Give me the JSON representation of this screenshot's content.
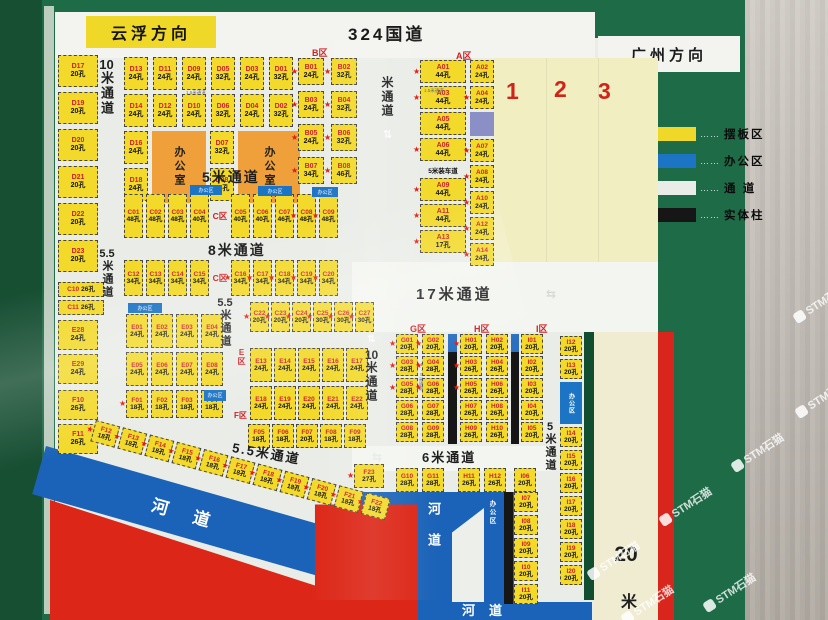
{
  "direction_top": {
    "left": "云浮方向",
    "center": "324国道",
    "right": "广州方向"
  },
  "legend": {
    "dots": "……",
    "items": [
      {
        "color": "#f0d829",
        "label": "摆板区"
      },
      {
        "color": "#1b74c4",
        "label": "办公区"
      },
      {
        "color": "#e9ece7",
        "label": "通  道"
      },
      {
        "color": "#161616",
        "label": "实体柱"
      }
    ]
  },
  "area_numbers": [
    "1",
    "2",
    "3"
  ],
  "zone_labels": {
    "a": "A区",
    "b": "B区",
    "c": "C区",
    "e": "E区",
    "f": "F区",
    "g": "G区",
    "h": "H区",
    "i": "I区"
  },
  "channels": {
    "left10_num": "10",
    "left10_txt": "米通道",
    "top5": "5米通道",
    "mid_v": "米通道",
    "mid8": "8米通道",
    "v55a_num": "5.5",
    "v55a_txt": "米通道",
    "v55b_num": "5.5",
    "v55b_txt": "米通道",
    "bottom55": "5.5米通道",
    "mid17": "17米通道",
    "ghi10_num": "10",
    "ghi10_txt": "米通道",
    "mid6": "6米通道",
    "right5_num": "5",
    "right5_txt": "米通道",
    "right20_num": "20",
    "right20_txt": "米",
    "small15": "1.5米通道",
    "load5": "5米装车道",
    "arrow_v": "⇅",
    "arrow_h": "⇆"
  },
  "offices": {
    "label": "办公室",
    "area_label": "办公区"
  },
  "river": {
    "label": "河道"
  },
  "watermark": {
    "text": "STM石猫"
  },
  "groups": {
    "left_d": [
      {
        "id": "D17",
        "cap": "20孔"
      },
      {
        "id": "D19",
        "cap": "20孔"
      },
      {
        "id": "D20",
        "cap": "20孔"
      },
      {
        "id": "D21",
        "cap": "20孔"
      },
      {
        "id": "D22",
        "cap": "20孔"
      },
      {
        "id": "D23",
        "cap": "20孔"
      }
    ],
    "left_c": [
      {
        "id": "C10",
        "cap": "26孔"
      },
      {
        "id": "C11",
        "cap": "26孔"
      }
    ],
    "left_e": [
      {
        "id": "E28",
        "cap": "24孔"
      },
      {
        "id": "E29",
        "cap": "24孔"
      }
    ],
    "left_f": [
      {
        "id": "F10",
        "cap": "26孔"
      },
      {
        "id": "F11",
        "cap": "26孔"
      }
    ],
    "d_row1": [
      {
        "id": "D13",
        "cap": "24孔"
      },
      {
        "id": "D11",
        "cap": "24孔"
      },
      {
        "id": "D09",
        "cap": "24孔"
      },
      {
        "id": "D05",
        "cap": "32孔"
      },
      {
        "id": "D03",
        "cap": "24孔"
      },
      {
        "id": "D01",
        "cap": "32孔"
      }
    ],
    "d_row2": [
      {
        "id": "D14",
        "cap": "24孔"
      },
      {
        "id": "D12",
        "cap": "24孔"
      },
      {
        "id": "D10",
        "cap": "24孔"
      },
      {
        "id": "D06",
        "cap": "32孔"
      },
      {
        "id": "D04",
        "cap": "24孔"
      },
      {
        "id": "D02",
        "cap": "32孔"
      }
    ],
    "d_col_a": [
      {
        "id": "D16",
        "cap": "24孔"
      },
      {
        "id": "D18",
        "cap": "24孔"
      }
    ],
    "d_col_b": [
      {
        "id": "D07",
        "cap": "32孔"
      },
      {
        "id": "D08",
        "cap": "32孔"
      }
    ],
    "b_zone": [
      {
        "id": "B01",
        "cap": "24孔",
        "star": 1
      },
      {
        "id": "B02",
        "cap": "32孔",
        "star": 1
      },
      {
        "id": "B03",
        "cap": "24孔",
        "star": 1
      },
      {
        "id": "B04",
        "cap": "32孔",
        "star": 1
      },
      {
        "id": "B05",
        "cap": "24孔",
        "star": 1
      },
      {
        "id": "B06",
        "cap": "32孔",
        "star": 1
      },
      {
        "id": "B07",
        "cap": "34孔",
        "star": 1
      },
      {
        "id": "B08",
        "cap": "46孔",
        "star": 1
      }
    ],
    "a_left": [
      {
        "id": "A01",
        "cap": "44孔",
        "star": 1
      },
      {
        "id": "A03",
        "cap": "44孔",
        "star": 1
      },
      {
        "id": "A05",
        "cap": "44孔"
      },
      {
        "id": "A06",
        "cap": "44孔",
        "star": 1
      },
      {
        "label": "5米装车道",
        "cls": "load",
        "h": 11
      },
      {
        "id": "A09",
        "cap": "44孔",
        "star": 1
      },
      {
        "id": "A11",
        "cap": "44孔",
        "star": 1
      },
      {
        "id": "A13",
        "cap": "17孔",
        "star": 1
      }
    ],
    "a_right": [
      {
        "id": "A02",
        "cap": "24孔"
      },
      {
        "id": "A04",
        "cap": "24孔",
        "star": 1
      },
      {
        "block": "#8a8fc5",
        "h": 24
      },
      {
        "id": "A07",
        "cap": "24孔",
        "star": 1
      },
      {
        "id": "A08",
        "cap": "24孔",
        "star": 1
      },
      {
        "id": "A10",
        "cap": "24孔",
        "star": 1
      },
      {
        "id": "A12",
        "cap": "24孔",
        "star": 1
      },
      {
        "id": "A14",
        "cap": "24孔",
        "star": 1
      }
    ],
    "c_row1": [
      {
        "id": "C01",
        "cap": "48孔"
      },
      {
        "id": "C02",
        "cap": "48孔"
      },
      {
        "id": "C03",
        "cap": "48孔"
      },
      {
        "id": "C04",
        "cap": "40孔"
      },
      {
        "label": "C区",
        "cls": "zred",
        "w": 16
      },
      {
        "id": "C05",
        "cap": "40孔"
      },
      {
        "id": "C06",
        "cap": "40孔"
      },
      {
        "id": "C07",
        "cap": "46孔"
      },
      {
        "id": "C08",
        "cap": "48孔",
        "star": 1
      },
      {
        "id": "C09",
        "cap": "48孔",
        "star": 1
      }
    ],
    "c_row2": [
      {
        "id": "C12",
        "cap": "34孔"
      },
      {
        "id": "C13",
        "cap": "34孔"
      },
      {
        "id": "C14",
        "cap": "34孔"
      },
      {
        "id": "C15",
        "cap": "34孔"
      },
      {
        "label": "C区",
        "cls": "zred",
        "w": 16
      },
      {
        "id": "C16",
        "cap": "34孔",
        "star": 1
      },
      {
        "id": "C17",
        "cap": "34孔",
        "star": 1
      },
      {
        "id": "C18",
        "cap": "34孔",
        "star": 1
      },
      {
        "id": "C19",
        "cap": "34孔",
        "star": 1
      },
      {
        "id": "C20",
        "cap": "34孔",
        "star": 1
      }
    ],
    "e_row1": [
      {
        "id": "E01",
        "cap": "24孔"
      },
      {
        "id": "E02",
        "cap": "24孔"
      },
      {
        "id": "E03",
        "cap": "24孔"
      },
      {
        "id": "E04",
        "cap": "24孔"
      }
    ],
    "e_row2": [
      {
        "id": "E05",
        "cap": "24孔"
      },
      {
        "id": "E06",
        "cap": "24孔"
      },
      {
        "id": "E07",
        "cap": "24孔"
      },
      {
        "id": "E08",
        "cap": "24孔"
      }
    ],
    "f_row1": [
      {
        "id": "F01",
        "cap": "18孔",
        "star": 1
      },
      {
        "id": "F02",
        "cap": "18孔"
      },
      {
        "id": "F03",
        "cap": "18孔"
      },
      {
        "id": "F04",
        "cap": "18孔"
      }
    ],
    "c_right": [
      {
        "id": "C22",
        "cap": "20孔",
        "star": 1
      },
      {
        "id": "C23",
        "cap": "20孔",
        "star": 1
      },
      {
        "id": "C24",
        "cap": "20孔",
        "star": 1
      },
      {
        "id": "C25",
        "cap": "30孔",
        "star": 1
      },
      {
        "id": "C26",
        "cap": "30孔",
        "star": 1
      },
      {
        "id": "C27",
        "cap": "30孔",
        "star": 1
      }
    ],
    "e_row3": [
      {
        "id": "E13",
        "cap": "24孔"
      },
      {
        "id": "E14",
        "cap": "24孔"
      },
      {
        "id": "E15",
        "cap": "24孔"
      },
      {
        "id": "E16",
        "cap": "24孔"
      },
      {
        "id": "E17",
        "cap": "24孔"
      }
    ],
    "e_row4": [
      {
        "id": "E18",
        "cap": "24孔"
      },
      {
        "id": "E19",
        "cap": "24孔"
      },
      {
        "id": "E20",
        "cap": "24孔"
      },
      {
        "id": "E21",
        "cap": "24孔"
      },
      {
        "id": "E22",
        "cap": "24孔"
      }
    ],
    "f_row2": [
      {
        "id": "F05",
        "cap": "18孔"
      },
      {
        "id": "F06",
        "cap": "18孔"
      },
      {
        "id": "F07",
        "cap": "20孔"
      },
      {
        "id": "F08",
        "cap": "18孔"
      },
      {
        "id": "F09",
        "cap": "18孔"
      }
    ],
    "g_col1": [
      {
        "id": "G01",
        "cap": "20孔",
        "star": 1
      },
      {
        "id": "G03",
        "cap": "28孔",
        "star": 1
      },
      {
        "id": "G05",
        "cap": "28孔",
        "star": 1
      },
      {
        "id": "G06",
        "cap": "28孔"
      },
      {
        "id": "G08",
        "cap": "28孔"
      }
    ],
    "g_col2": [
      {
        "id": "G02",
        "cap": "20孔",
        "star": 1
      },
      {
        "id": "G04",
        "cap": "28孔",
        "star": 1
      },
      {
        "id": "G06",
        "cap": "28孔",
        "star": 1
      },
      {
        "id": "G07",
        "cap": "28孔"
      },
      {
        "id": "G09",
        "cap": "28孔"
      }
    ],
    "h_col1": [
      {
        "id": "H01",
        "cap": "20孔",
        "star": 1
      },
      {
        "id": "H03",
        "cap": "26孔",
        "star": 1
      },
      {
        "id": "H05",
        "cap": "26孔",
        "star": 1
      },
      {
        "id": "H07",
        "cap": "26孔"
      },
      {
        "id": "H09",
        "cap": "26孔"
      }
    ],
    "h_col2": [
      {
        "id": "H02",
        "cap": "20孔"
      },
      {
        "id": "H04",
        "cap": "26孔"
      },
      {
        "id": "H06",
        "cap": "26孔"
      },
      {
        "id": "H08",
        "cap": "26孔"
      },
      {
        "id": "H10",
        "cap": "26孔"
      }
    ],
    "i_col": [
      {
        "id": "I01",
        "cap": "20孔"
      },
      {
        "id": "I02",
        "cap": "20孔"
      },
      {
        "id": "I03",
        "cap": "20孔"
      },
      {
        "id": "I04",
        "cap": "20孔"
      },
      {
        "id": "I05",
        "cap": "20孔"
      }
    ],
    "f23": [
      {
        "id": "F23",
        "cap": "27孔",
        "star": 1
      }
    ],
    "bottom_row": [
      {
        "id": "G10",
        "cap": "28孔"
      },
      {
        "id": "G11",
        "cap": "28孔",
        "ml": 4
      },
      {
        "id": "H11",
        "cap": "26孔",
        "ml": 14
      },
      {
        "id": "H12",
        "cap": "26孔",
        "ml": 4
      },
      {
        "id": "I06",
        "cap": "20孔",
        "ml": 8
      }
    ],
    "i_lower": [
      {
        "id": "I07",
        "cap": "20孔"
      },
      {
        "id": "I08",
        "cap": "20孔"
      },
      {
        "id": "I09",
        "cap": "20孔"
      },
      {
        "id": "I10",
        "cap": "20孔"
      },
      {
        "id": "I11",
        "cap": "20孔"
      }
    ],
    "i_right": [
      {
        "id": "I12",
        "cap": "20孔"
      },
      {
        "id": "I13",
        "cap": "20孔"
      },
      {
        "block": "#1b74c4",
        "h": 42,
        "text": "办公区"
      },
      {
        "id": "I14",
        "cap": "20孔"
      },
      {
        "id": "I15",
        "cap": "20孔"
      },
      {
        "id": "I16",
        "cap": "20孔"
      },
      {
        "id": "I17",
        "cap": "20孔"
      },
      {
        "id": "I18",
        "cap": "20孔"
      },
      {
        "id": "I19",
        "cap": "20孔"
      },
      {
        "id": "I20",
        "cap": "20孔"
      }
    ],
    "f_diag": [
      {
        "id": "F12",
        "cap": "18孔",
        "star": 1
      },
      {
        "id": "F13",
        "cap": "18孔",
        "star": 1
      },
      {
        "id": "F14",
        "cap": "18孔",
        "star": 1
      },
      {
        "id": "F15",
        "cap": "18孔",
        "star": 1
      },
      {
        "id": "F16",
        "cap": "18孔",
        "star": 1
      },
      {
        "id": "F17",
        "cap": "18孔",
        "star": 1
      },
      {
        "id": "F18",
        "cap": "18孔",
        "star": 1
      },
      {
        "id": "F19",
        "cap": "18孔",
        "star": 1
      },
      {
        "id": "F20",
        "cap": "18孔",
        "star": 1
      },
      {
        "id": "F21",
        "cap": "18孔",
        "star": 1
      },
      {
        "id": "F22",
        "cap": "18孔",
        "star": 1
      }
    ]
  }
}
